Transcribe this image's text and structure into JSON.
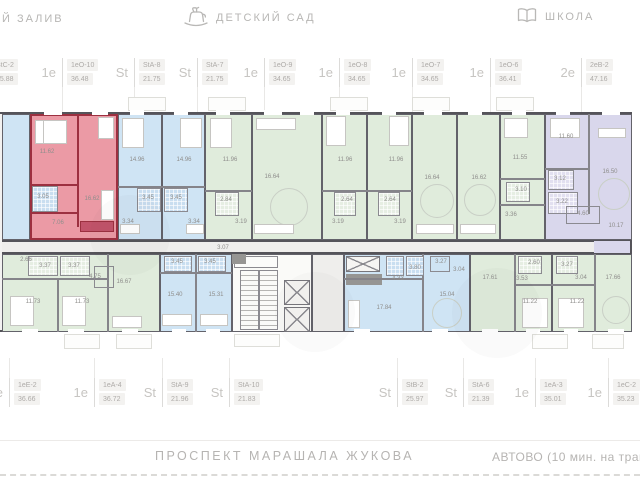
{
  "landmarks": {
    "gulf": "Й ЗАЛИВ",
    "kindergarten": "ДЕТСКИЙ САД",
    "school": "ШКОЛА"
  },
  "units_top": [
    {
      "x": -13,
      "type": "St",
      "code": "StC-2",
      "area": "25.88"
    },
    {
      "x": 62,
      "type": "1е",
      "code": "1еО-10",
      "area": "36.48"
    },
    {
      "x": 134,
      "type": "St",
      "code": "StA-8",
      "area": "21.75"
    },
    {
      "x": 197,
      "type": "St",
      "code": "StA-7",
      "area": "21.75"
    },
    {
      "x": 264,
      "type": "1е",
      "code": "1еО-9",
      "area": "34.65"
    },
    {
      "x": 339,
      "type": "1е",
      "code": "1еО-8",
      "area": "34.65"
    },
    {
      "x": 412,
      "type": "1е",
      "code": "1еО-7",
      "area": "34.65"
    },
    {
      "x": 490,
      "type": "1е",
      "code": "1еО-6",
      "area": "36.41"
    },
    {
      "x": 581,
      "type": "2е",
      "code": "2еВ-2",
      "area": "47.16"
    }
  ],
  "units_bottom": [
    {
      "x": 9,
      "type": "1е",
      "code": "1еЕ-2",
      "area": "36.66"
    },
    {
      "x": 94,
      "type": "1е",
      "code": "1еА-4",
      "area": "36.72"
    },
    {
      "x": 162,
      "type": "St",
      "code": "StA-9",
      "area": "21.96"
    },
    {
      "x": 229,
      "type": "St",
      "code": "StA-10",
      "area": "21.83"
    },
    {
      "x": 397,
      "type": "St",
      "code": "StB-2",
      "area": "25.97"
    },
    {
      "x": 463,
      "type": "St",
      "code": "StA-6",
      "area": "21.39"
    },
    {
      "x": 535,
      "type": "1е",
      "code": "1еА-3",
      "area": "35.01"
    },
    {
      "x": 608,
      "type": "1е",
      "code": "1еС-2",
      "area": "35.23"
    }
  ],
  "plan": {
    "colors": {
      "highlight_fill": "#eb9aa5",
      "highlight_wall": "#9c3040",
      "studio_blue": "#cfe4f4",
      "one_room_green": "#e0ecdc",
      "two_room_purple": "#d9d7ec",
      "walls": "#55545a"
    },
    "room_labels": [
      {
        "x": 47,
        "y": 152,
        "v": "11.62"
      },
      {
        "x": 92,
        "y": 199,
        "v": "16.62"
      },
      {
        "x": 43,
        "y": 197,
        "v": "3.05"
      },
      {
        "x": 58,
        "y": 223,
        "v": "7.06"
      },
      {
        "x": 137,
        "y": 160,
        "v": "14.96"
      },
      {
        "x": 148,
        "y": 198,
        "v": "3.45"
      },
      {
        "x": 128,
        "y": 222,
        "v": "3.34"
      },
      {
        "x": 184,
        "y": 160,
        "v": "14.96"
      },
      {
        "x": 176,
        "y": 198,
        "v": "3.45"
      },
      {
        "x": 194,
        "y": 222,
        "v": "3.34"
      },
      {
        "x": 230,
        "y": 160,
        "v": "11.96"
      },
      {
        "x": 226,
        "y": 200,
        "v": "2.84"
      },
      {
        "x": 241,
        "y": 222,
        "v": "3.19"
      },
      {
        "x": 272,
        "y": 177,
        "v": "16.64"
      },
      {
        "x": 345,
        "y": 160,
        "v": "11.96"
      },
      {
        "x": 347,
        "y": 200,
        "v": "2.64"
      },
      {
        "x": 338,
        "y": 222,
        "v": "3.19"
      },
      {
        "x": 396,
        "y": 160,
        "v": "11.96"
      },
      {
        "x": 390,
        "y": 200,
        "v": "2.64"
      },
      {
        "x": 400,
        "y": 222,
        "v": "3.19"
      },
      {
        "x": 432,
        "y": 178,
        "v": "16.64"
      },
      {
        "x": 479,
        "y": 178,
        "v": "16.62"
      },
      {
        "x": 520,
        "y": 158,
        "v": "11.55"
      },
      {
        "x": 521,
        "y": 190,
        "v": "3.10"
      },
      {
        "x": 511,
        "y": 215,
        "v": "3.36"
      },
      {
        "x": 566,
        "y": 137,
        "v": "11.60"
      },
      {
        "x": 610,
        "y": 172,
        "v": "16.50"
      },
      {
        "x": 560,
        "y": 179,
        "v": "3.12"
      },
      {
        "x": 562,
        "y": 202,
        "v": "3.22"
      },
      {
        "x": 583,
        "y": 214,
        "v": "4.60"
      },
      {
        "x": 616,
        "y": 226,
        "v": "10.17"
      },
      {
        "x": 26,
        "y": 260,
        "v": "2.66"
      },
      {
        "x": 45,
        "y": 266,
        "v": "3.37"
      },
      {
        "x": 74,
        "y": 266,
        "v": "3.37"
      },
      {
        "x": 95,
        "y": 277,
        "v": "4.75"
      },
      {
        "x": 124,
        "y": 282,
        "v": "16.67"
      },
      {
        "x": 33,
        "y": 302,
        "v": "11.73"
      },
      {
        "x": 82,
        "y": 302,
        "v": "11.73"
      },
      {
        "x": 177,
        "y": 262,
        "v": "3.45"
      },
      {
        "x": 210,
        "y": 262,
        "v": "3.45"
      },
      {
        "x": 223,
        "y": 248,
        "v": "3.07"
      },
      {
        "x": 175,
        "y": 295,
        "v": "15.40"
      },
      {
        "x": 216,
        "y": 295,
        "v": "15.31"
      },
      {
        "x": 384,
        "y": 308,
        "v": "17.84"
      },
      {
        "x": 398,
        "y": 279,
        "v": "4.33"
      },
      {
        "x": 415,
        "y": 268,
        "v": "3.80"
      },
      {
        "x": 441,
        "y": 262,
        "v": "3.27"
      },
      {
        "x": 459,
        "y": 270,
        "v": "3.04"
      },
      {
        "x": 447,
        "y": 295,
        "v": "15.04"
      },
      {
        "x": 490,
        "y": 278,
        "v": "17.61"
      },
      {
        "x": 522,
        "y": 279,
        "v": "3.53"
      },
      {
        "x": 530,
        "y": 302,
        "v": "11.22"
      },
      {
        "x": 534,
        "y": 263,
        "v": "2.60"
      },
      {
        "x": 567,
        "y": 265,
        "v": "3.27"
      },
      {
        "x": 581,
        "y": 278,
        "v": "3.04"
      },
      {
        "x": 577,
        "y": 302,
        "v": "11.22"
      },
      {
        "x": 613,
        "y": 278,
        "v": "17.66"
      }
    ]
  },
  "street": {
    "name": "ПРОСПЕКТ МАРАШАЛА ЖУКОВА",
    "metro": "АВТОВО (10 мин. на трансп"
  }
}
